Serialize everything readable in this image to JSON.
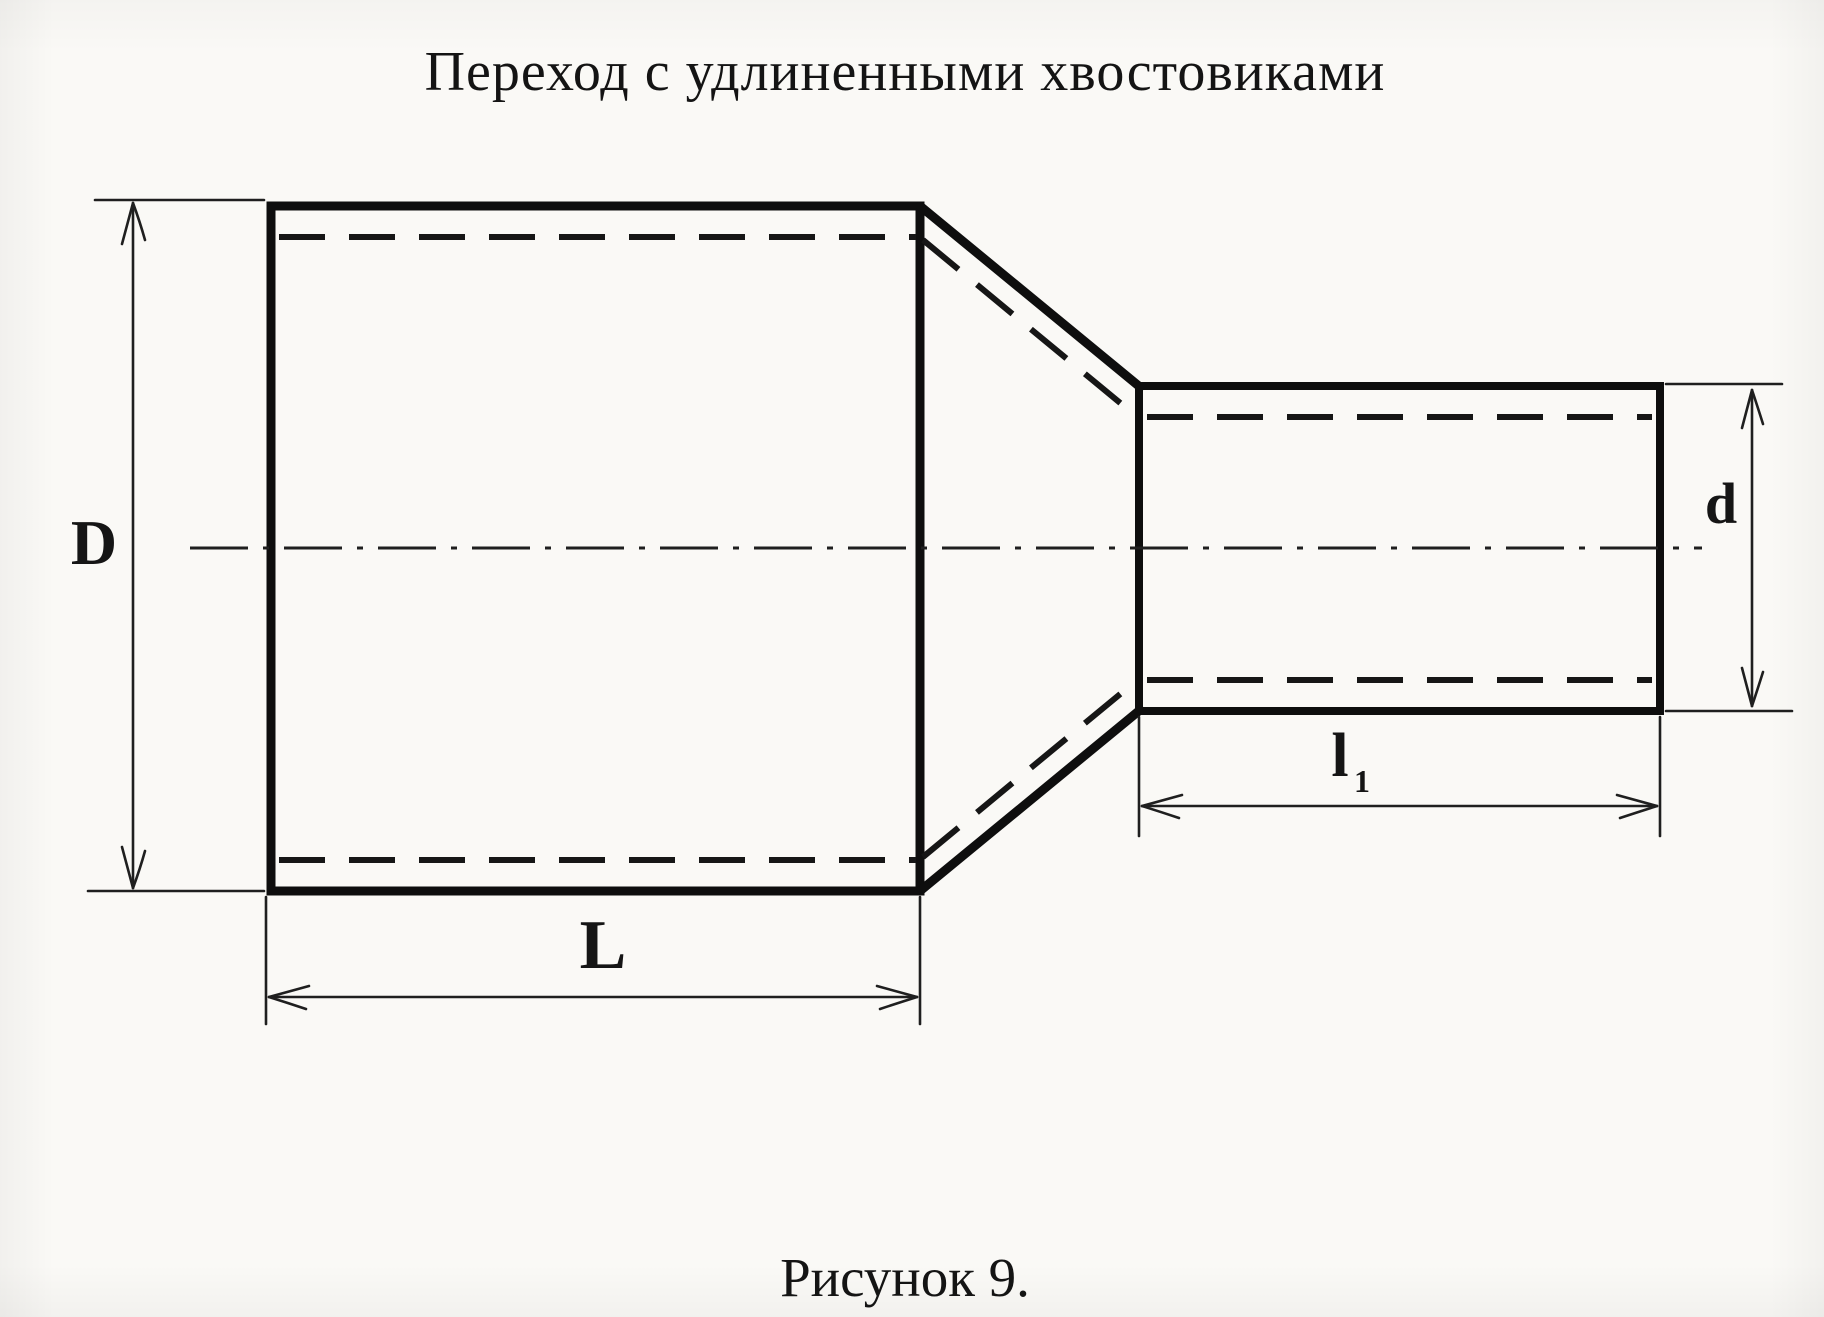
{
  "title": "Переход с удлиненными хвостовиками",
  "caption": "Рисунок 9.",
  "labels": {
    "outer_diameter_large": "D",
    "outer_diameter_small": "d",
    "length_large": "L",
    "length_small_base": "l",
    "length_small_subscript": "1"
  },
  "colors": {
    "ink": "#141414",
    "outline_ink": "#0e0e0e",
    "paper": "#faf9f6"
  }
}
